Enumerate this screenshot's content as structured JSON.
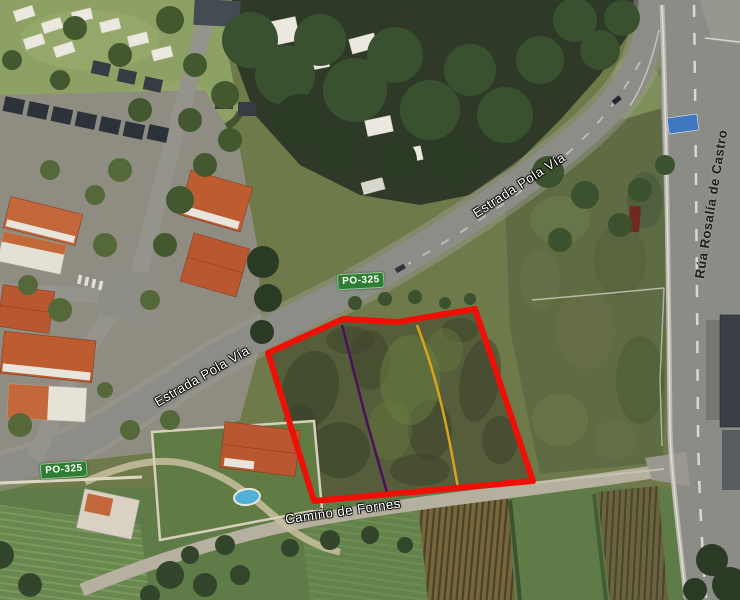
{
  "map": {
    "view_type": "satellite",
    "labels": {
      "road_estrada_upper": "Estrada Pola Vía",
      "road_estrada_lower": "Estrada Pola Vía",
      "road_rua_rosalia": "Rúa Rosalía de Castro",
      "road_camino_fornes": "Camiño de Fornes",
      "route_badge_left": "PO-325",
      "route_badge_center": "PO-325"
    },
    "overlay": {
      "parcel_outline_color": "#ee1007",
      "divider_purple_color": "#4a1058",
      "divider_orange_color": "#dba31c",
      "route_badge_color": "#2e7d32",
      "road_label_color": "#ffffff",
      "vertical_road_label_color": "#1e1e1e"
    }
  }
}
